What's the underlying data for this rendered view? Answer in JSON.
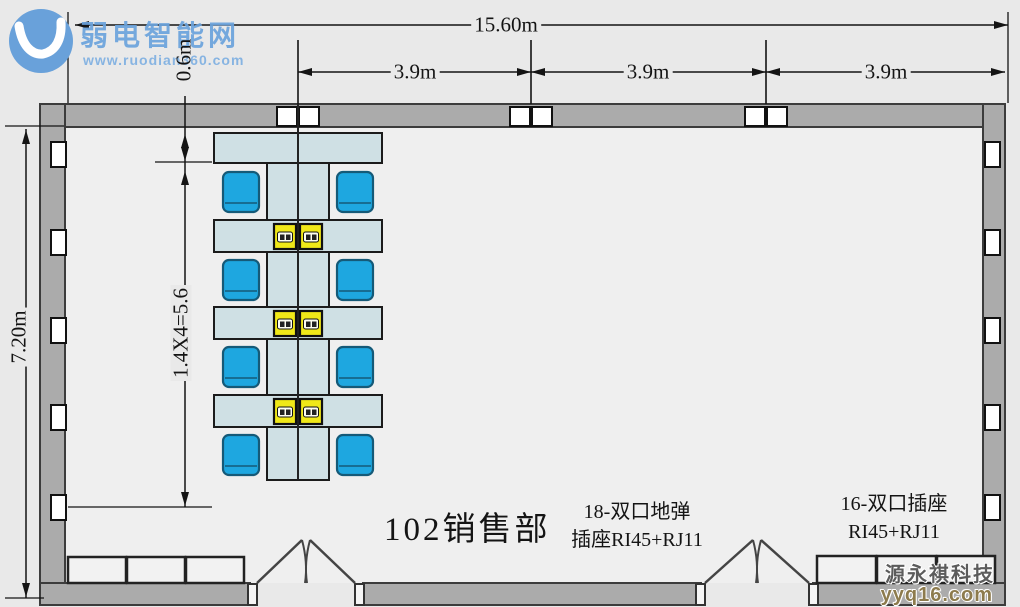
{
  "branding_top": {
    "name": "弱电智能网",
    "url": "www.ruodian360.com"
  },
  "branding_bottom": {
    "company": "源永祺科技",
    "url": "yyq16.com"
  },
  "room": {
    "label": "102销售部"
  },
  "dimensions": {
    "total_width": "15.60m",
    "bays": [
      "3.9m",
      "3.9m",
      "3.9m"
    ],
    "total_height": "7.20m",
    "desk_depth": "0.6m",
    "row_pitch": "1.4X4=5.6"
  },
  "annotations": {
    "floor_socket_line1": "18-双口地弹",
    "floor_socket_line2": "插座RI45+RJ11",
    "wall_socket_line1": "16-双口插座",
    "wall_socket_line2": "RI45+RJ11"
  },
  "colors": {
    "bg": "#e9e9e9",
    "floor": "#efefef",
    "wall": "#ababab",
    "wall_stroke": "#3c3c3c",
    "desk": "#cfe0e4",
    "desk_stroke": "#1b1b1b",
    "chair": "#1ea7e0",
    "chair_stroke": "#155a78",
    "chair_band": "#1693cc",
    "socket_yellow": "#f0e818",
    "white_box": "#ffffff",
    "cabinet": "#f2f2f2",
    "line": "#141414",
    "logo_blue": "#69a1da"
  },
  "floorplan": {
    "walls": {
      "top": [
        40,
        104,
        965,
        23
      ],
      "left": [
        40,
        104,
        25,
        501
      ],
      "right": [
        983,
        104,
        22,
        501
      ],
      "bottom_segments": [
        [
          40,
          583,
          210,
          22
        ],
        [
          363,
          583,
          338,
          22
        ],
        [
          813,
          583,
          192,
          22
        ]
      ]
    },
    "doors": [
      {
        "cx": 306,
        "half": 53
      },
      {
        "cx": 757,
        "half": 56
      }
    ],
    "top_wall_box_cx": [
      298,
      531,
      766
    ],
    "side_socket_ys": [
      142,
      230,
      318,
      405,
      495
    ],
    "cabinets": [
      [
        68,
        557,
        58,
        26
      ],
      [
        127,
        557,
        58,
        26
      ],
      [
        186,
        557,
        58,
        26
      ],
      [
        817,
        556,
        59,
        27
      ],
      [
        877,
        556,
        59,
        27
      ],
      [
        937,
        556,
        58,
        27
      ]
    ],
    "clusters": {
      "cx": [
        298,
        531,
        766
      ],
      "top_desk_y": 133,
      "row_ys": [
        220,
        307,
        395
      ],
      "gap_ys": [
        172,
        260,
        347,
        435
      ],
      "spine_y1": 163,
      "spine_y2": 480
    },
    "side_columns": {
      "left_x": 68,
      "right_edge": 983,
      "branch_ys": [
        133,
        222,
        310,
        397
      ],
      "chair_ys": [
        174,
        262,
        349,
        437
      ]
    },
    "dim_lines": {
      "total_width_y": 25,
      "bay_y": 72,
      "height_x": 26,
      "inner_x": 185
    }
  }
}
